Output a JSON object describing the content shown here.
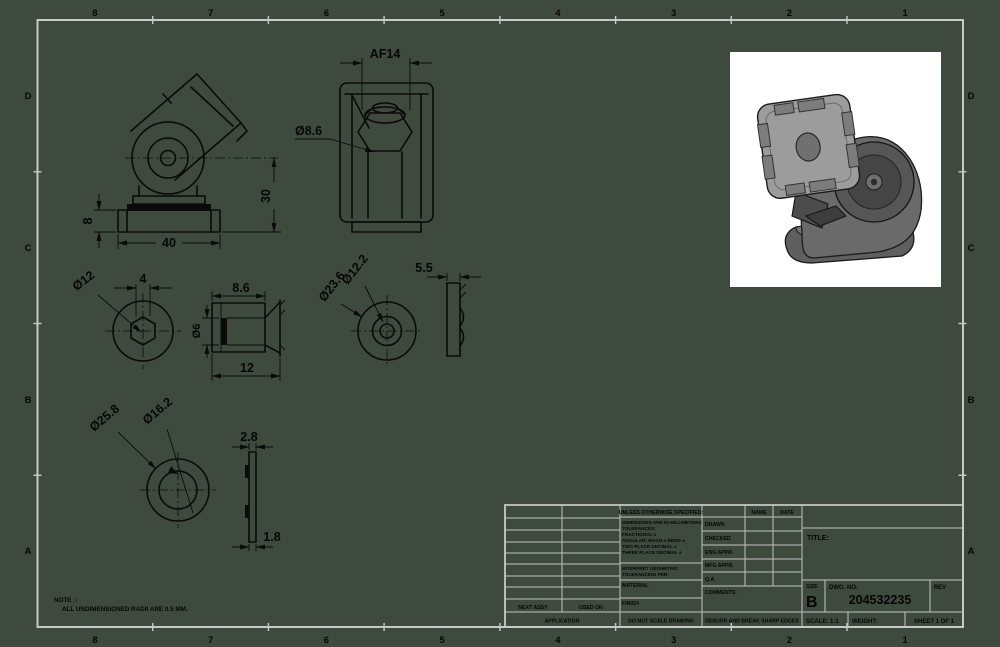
{
  "sheet": {
    "background_color": "#3f4a3f",
    "frame_color": "#c8c8c8",
    "drawing_color": "#0a0a0a",
    "zones_top": [
      "8",
      "7",
      "6",
      "5",
      "4",
      "3",
      "2",
      "1"
    ],
    "zones_bottom": [
      "8",
      "7",
      "6",
      "5",
      "4",
      "3",
      "2",
      "1"
    ],
    "zones_left": [
      "D",
      "C",
      "B",
      "A"
    ],
    "zones_right": [
      "D",
      "C",
      "B",
      "A"
    ]
  },
  "views": {
    "front": {
      "dim_base_height": "8",
      "dim_width": "40",
      "dim_height": "30"
    },
    "top": {
      "dim_across_flats": "AF14",
      "dim_hole": "Ø8.6"
    },
    "hex_insert": {
      "dim_diameter": "Ø12",
      "dim_hex": "4"
    },
    "insert_side": {
      "dim_depth": "8.6",
      "dim_bore": "Ø6",
      "dim_length": "12"
    },
    "washer": {
      "dim_inner": "Ø12.2",
      "dim_outer": "Ø23.6"
    },
    "washer_side": {
      "dim_thickness": "5.5"
    },
    "large_washer": {
      "dim_outer": "Ø25.8",
      "dim_inner": "Ø16.2"
    },
    "clip_side": {
      "dim_top": "2.8",
      "dim_bottom": "1.8"
    }
  },
  "note": {
    "title": "NOTE :-",
    "text": "ALL UNDIMENSIONED RADII ARE 0.5 MM."
  },
  "title_block": {
    "tolerance_header": "UNLESS OTHERWISE SPECIFIED:",
    "tolerance_lines": [
      "DIMENSIONS ARE IN MILLIMETERS",
      "TOLERANCES:",
      "FRACTIONAL ±",
      "ANGULAR: MACH ±    BEND ±",
      "TWO PLACE DECIMAL     ±",
      "THREE PLACE DECIMAL   ±"
    ],
    "interpret_line1": "INTERPRET GEOMETRIC",
    "interpret_line2": "TOLERANCING PER:",
    "material_label": "MATERIAL",
    "finish_label": "FINISH",
    "name_header": "NAME",
    "date_header": "DATE",
    "approval_rows": [
      "DRAWN",
      "CHECKED",
      "ENG APPR.",
      "MFG APPR.",
      "Q.A.",
      "COMMENTS:"
    ],
    "next_assy": "NEXT ASSY",
    "used_on": "USED ON",
    "application": "APPLICATION",
    "do_not_scale": "DO NOT SCALE DRAWING",
    "deburr": "DEBURR AND BREAK SHARP EDGES",
    "title_label": "TITLE:",
    "size_label": "SIZE",
    "size_value": "B",
    "dwg_label": "DWG. NO.",
    "dwg_number": "204532235",
    "rev_label": "REV",
    "scale": "SCALE: 1:1",
    "weight": "WEIGHT:",
    "sheet": "SHEET 1 OF 1"
  },
  "render": {
    "box_color": "#ffffff",
    "plate_color": "#9c9c9c",
    "body_color": "#6a6a6a",
    "dark_color": "#474747"
  }
}
